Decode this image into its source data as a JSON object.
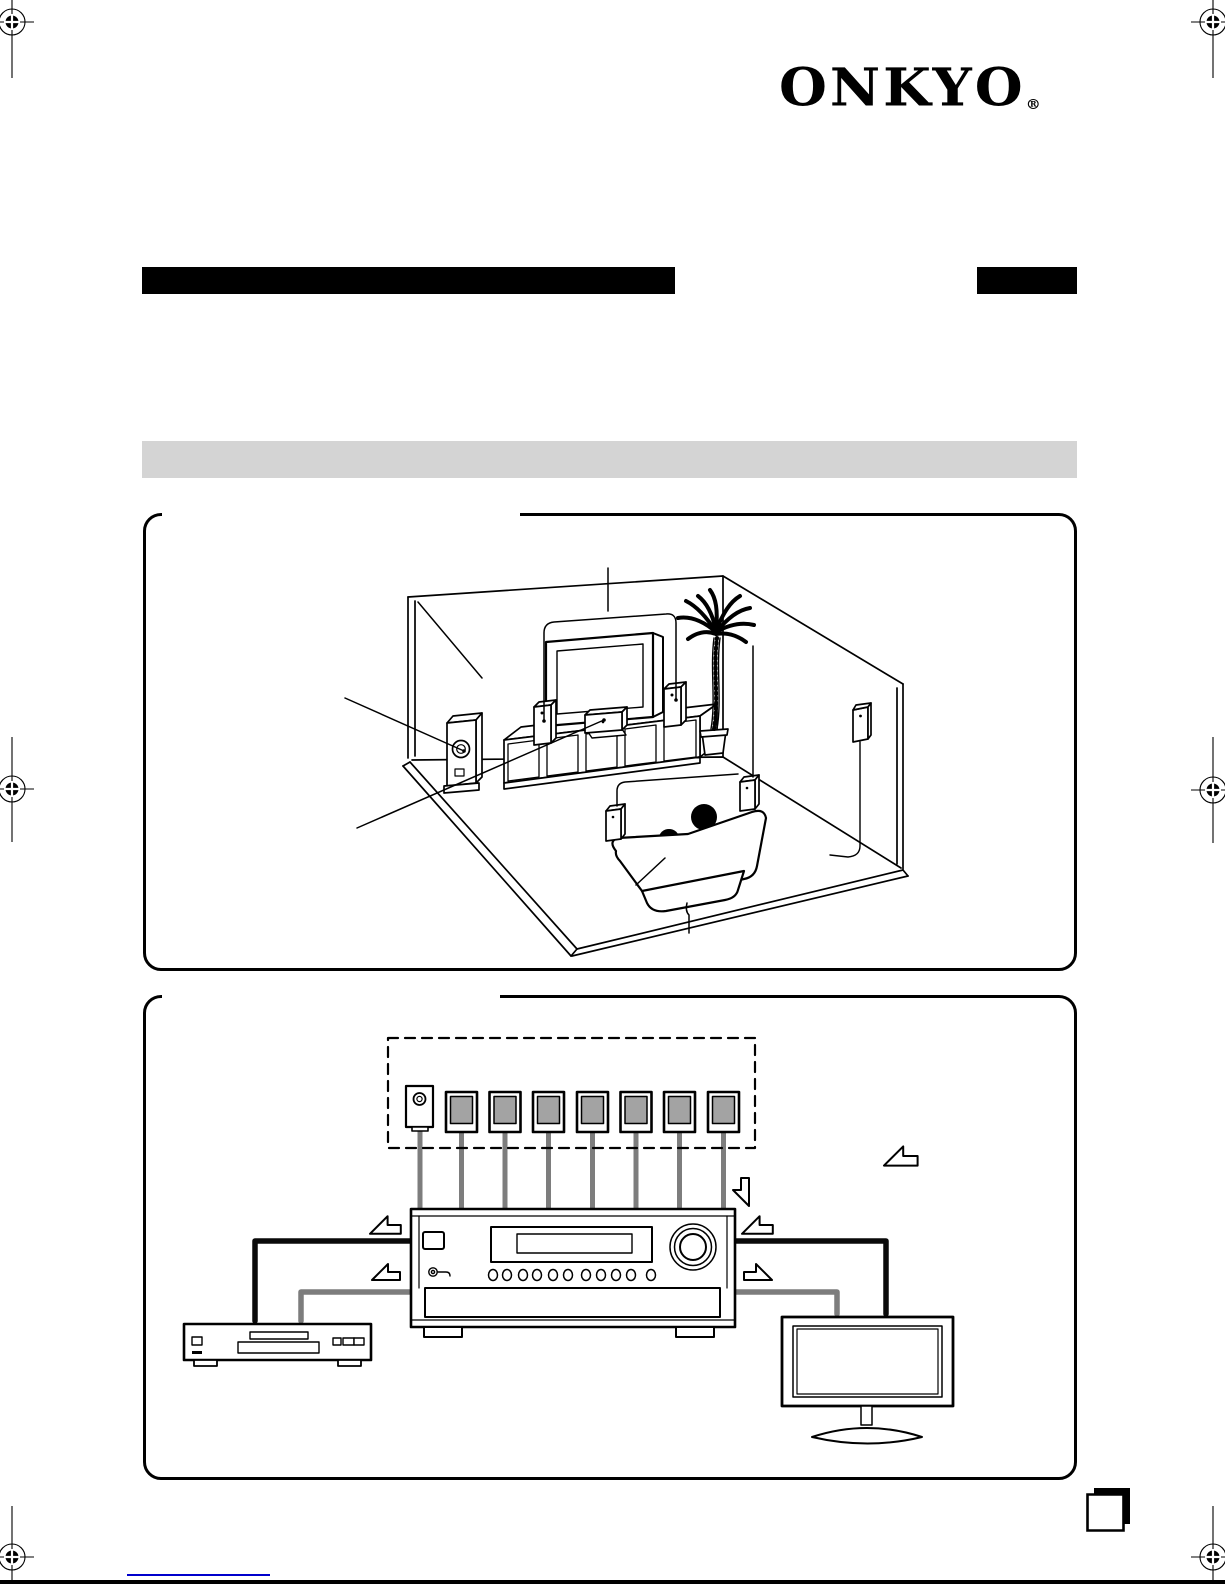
{
  "brand": {
    "logo_text": "ONKYO",
    "registered_mark": "®"
  },
  "masthead": {
    "title_bar": "solid-black-redacted-title",
    "edition_box": "solid-black-box",
    "section_bar": "gray-section-heading-bar"
  },
  "colors": {
    "ink": "#000000",
    "bar-gray": "#d4d4d4",
    "speaker-fill": "#a3a3a3",
    "wire-gray": "#7d7d7d",
    "cable-black": "#0a0a0a",
    "link-blue": "#0000cc",
    "paper": "#ffffff"
  },
  "room_panel": {
    "items": [
      "room-corner-walls-floor",
      "tv",
      "tv-cabinet",
      "center-speaker",
      "front-left-speaker",
      "front-right-speaker",
      "subwoofer",
      "palm-tree",
      "sofa",
      "listener-silhouette",
      "surround-left-speaker",
      "surround-right-speaker",
      "wall-mounted-speaker",
      "callout-leader-lines"
    ]
  },
  "wiring_panel": {
    "speaker_count": 7,
    "subwoofer_count": 1,
    "receiver_button_count": 11,
    "items": [
      "speaker-set-dashed-group",
      "speaker-wires",
      "av-receiver",
      "dvd-player",
      "tv-monitor",
      "audio-cable-black",
      "video-cable-gray",
      "page-reference-arrows"
    ]
  },
  "footer": {
    "link_underline": true,
    "page_corner_marker": true
  }
}
